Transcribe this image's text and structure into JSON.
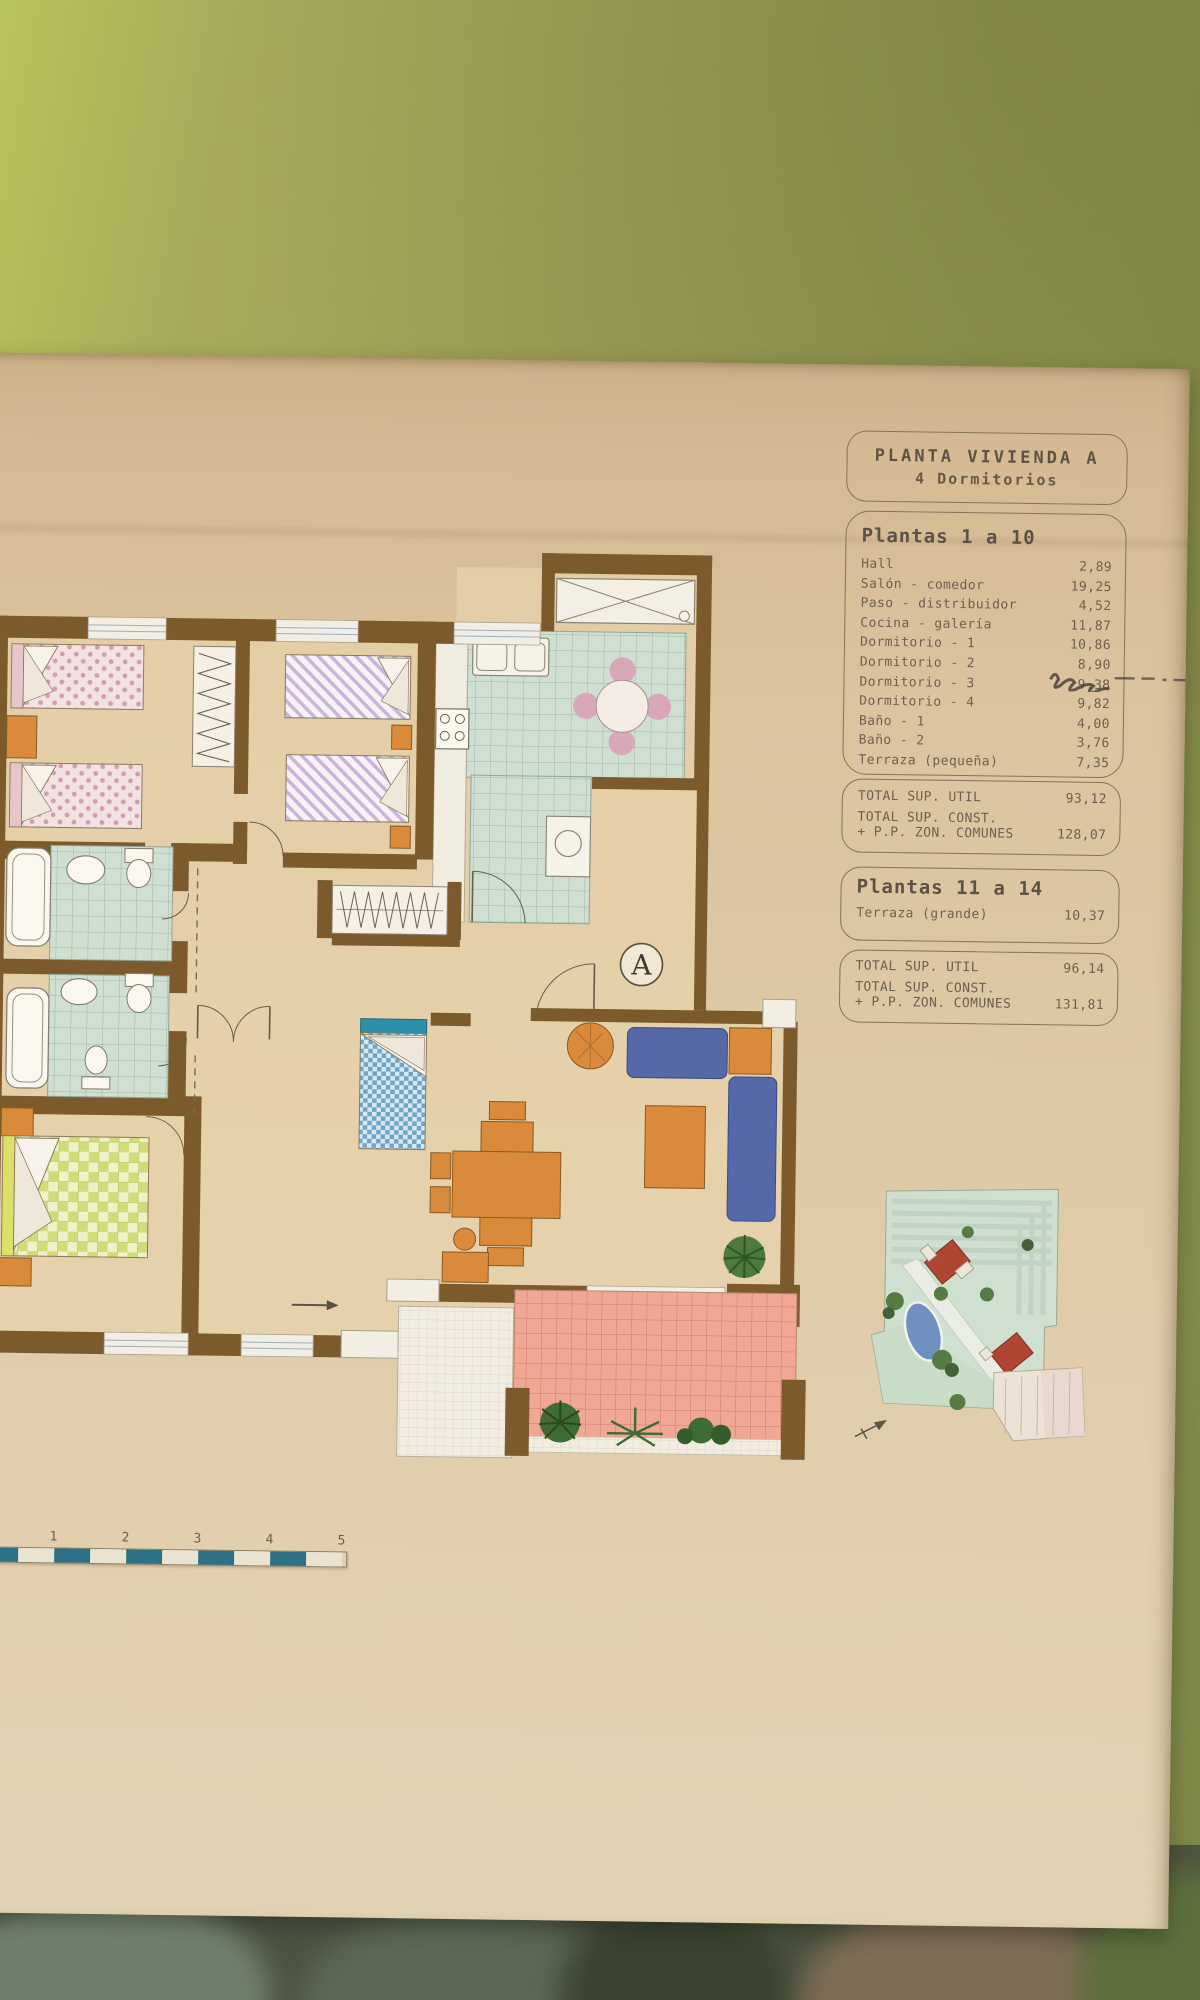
{
  "photo": {
    "wall_color": "#9b9e55",
    "poster_color": "#dfcba8",
    "wall_brown": "#7d5a2b",
    "accent_teal": "#2c7186"
  },
  "panel": {
    "title_line1": "PLANTA VIVIENDA A",
    "title_line2": "4 Dormitorios",
    "plantas_1_10_heading": "Plantas 1 a 10",
    "rooms": [
      {
        "label": "Hall",
        "value": "2,89"
      },
      {
        "label": "Salón - comedor",
        "value": "19,25"
      },
      {
        "label": "Paso - distribuidor",
        "value": "4,52"
      },
      {
        "label": "Cocina - galería",
        "value": "11,87"
      },
      {
        "label": "Dormitorio - 1",
        "value": "10,86"
      },
      {
        "label": "Dormitorio - 2",
        "value": "8,90"
      },
      {
        "label": "Dormitorio - 3",
        "value": "9,38",
        "note": "value obscured by pen scribble"
      },
      {
        "label": "Dormitorio - 4",
        "value": "9,82"
      },
      {
        "label": "Baño - 1",
        "value": "4,00"
      },
      {
        "label": "Baño - 2",
        "value": "3,76"
      },
      {
        "label": "Terraza (pequeña)",
        "value": "7,35"
      }
    ],
    "totals_1_10": {
      "util_label": "TOTAL SUP. UTIL",
      "util_value": "93,12",
      "const_label_line1": "TOTAL SUP. CONST.",
      "const_label_line2": "+ P.P. ZON. COMUNES",
      "const_value": "128,07"
    },
    "plantas_11_14_heading": "Plantas 11 a 14",
    "terraza_grande": {
      "label": "Terraza (grande)",
      "value": "10,37"
    },
    "totals_11_14": {
      "util_label": "TOTAL SUP. UTIL",
      "util_value": "96,14",
      "const_label_line1": "TOTAL SUP. CONST.",
      "const_label_line2": "+ P.P. ZON. COMUNES",
      "const_value": "131,81"
    }
  },
  "plan": {
    "unit_marker": "A"
  },
  "scale_bar": {
    "labels": [
      "0",
      "1",
      "2",
      "3",
      "4",
      "5"
    ]
  }
}
